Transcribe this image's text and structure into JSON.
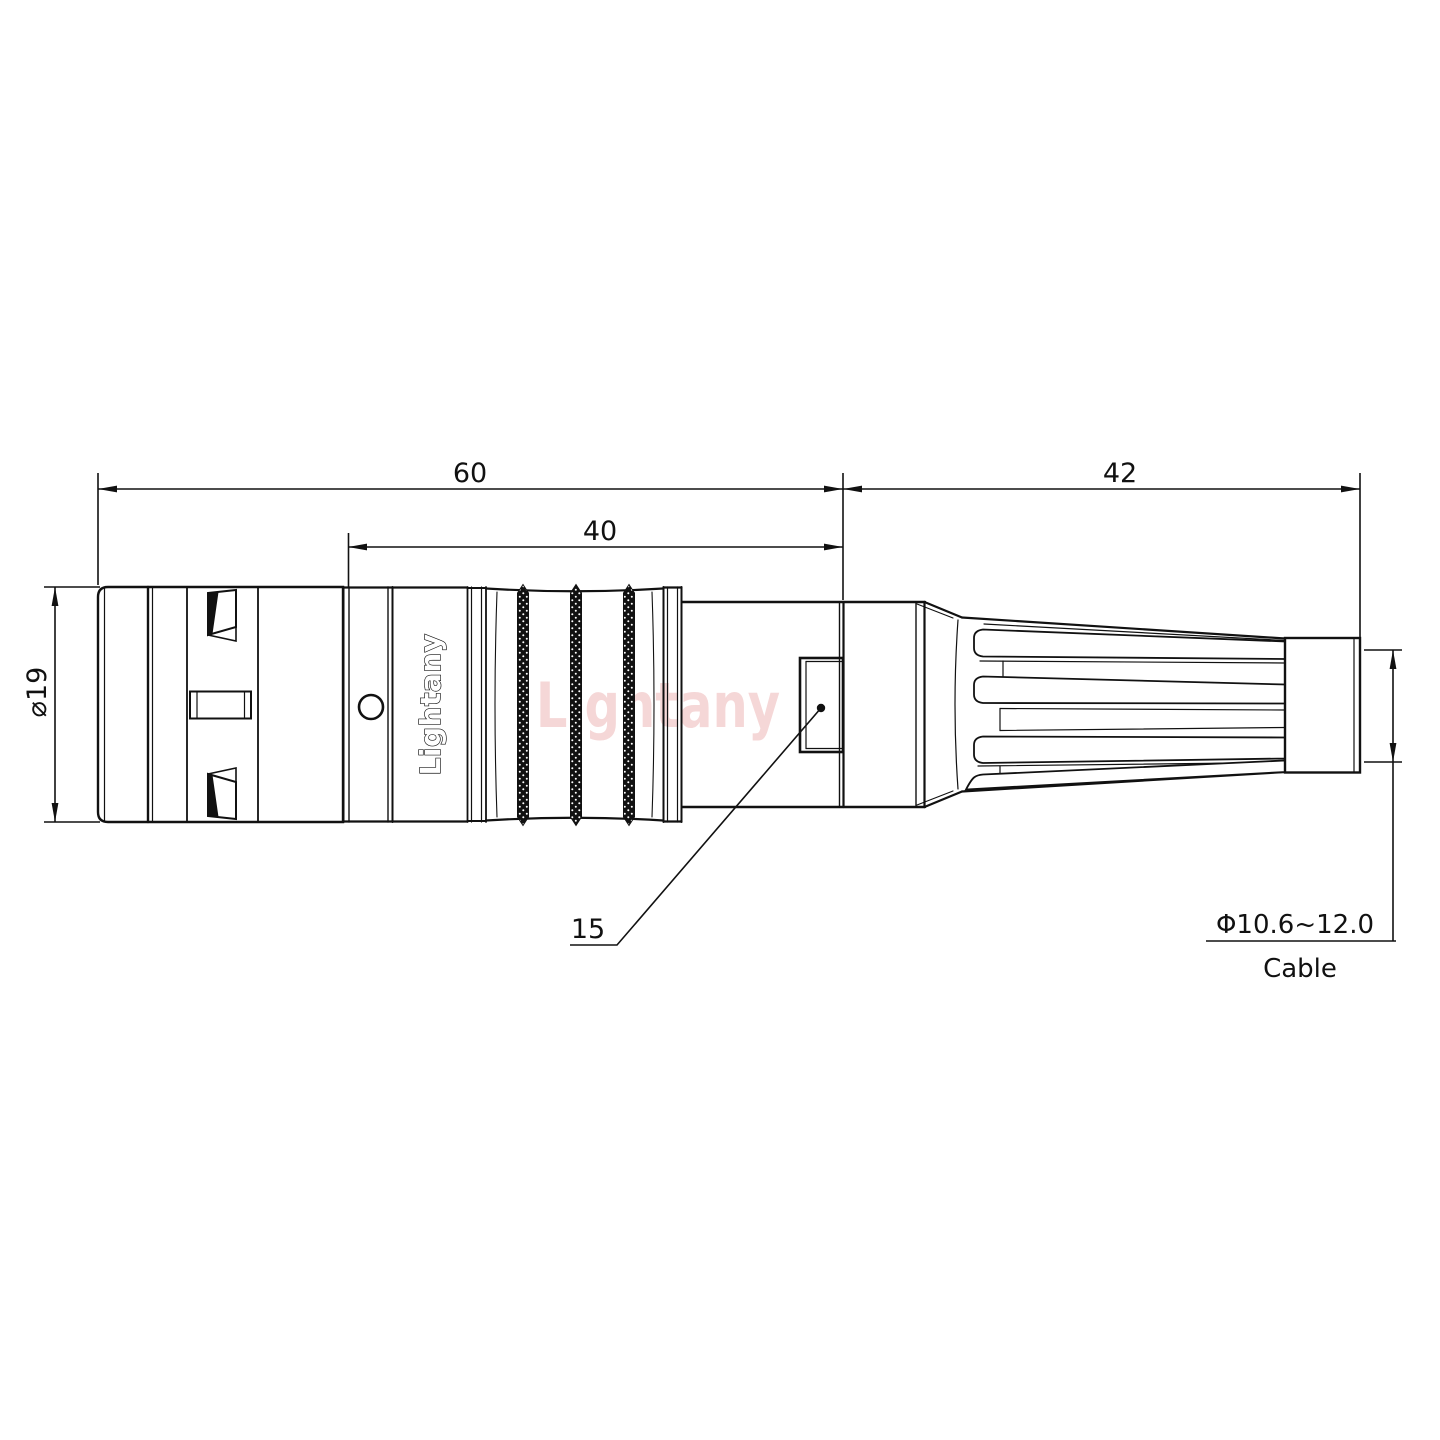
{
  "drawing": {
    "title": "connector-outline-drawing",
    "brand_on_body": "Lightany",
    "watermark": "Lightany",
    "dimensions": {
      "overall_length": "60",
      "mid_length": "40",
      "boot_length": "42",
      "front_diameter": "⌀19",
      "latch_callout": "15",
      "cable_diameter_range": "Φ10.6~12.0",
      "cable_label": "Cable"
    },
    "colors": {
      "line": "#111111",
      "background": "#ffffff",
      "watermark_pink": "#f5d7d7"
    }
  }
}
